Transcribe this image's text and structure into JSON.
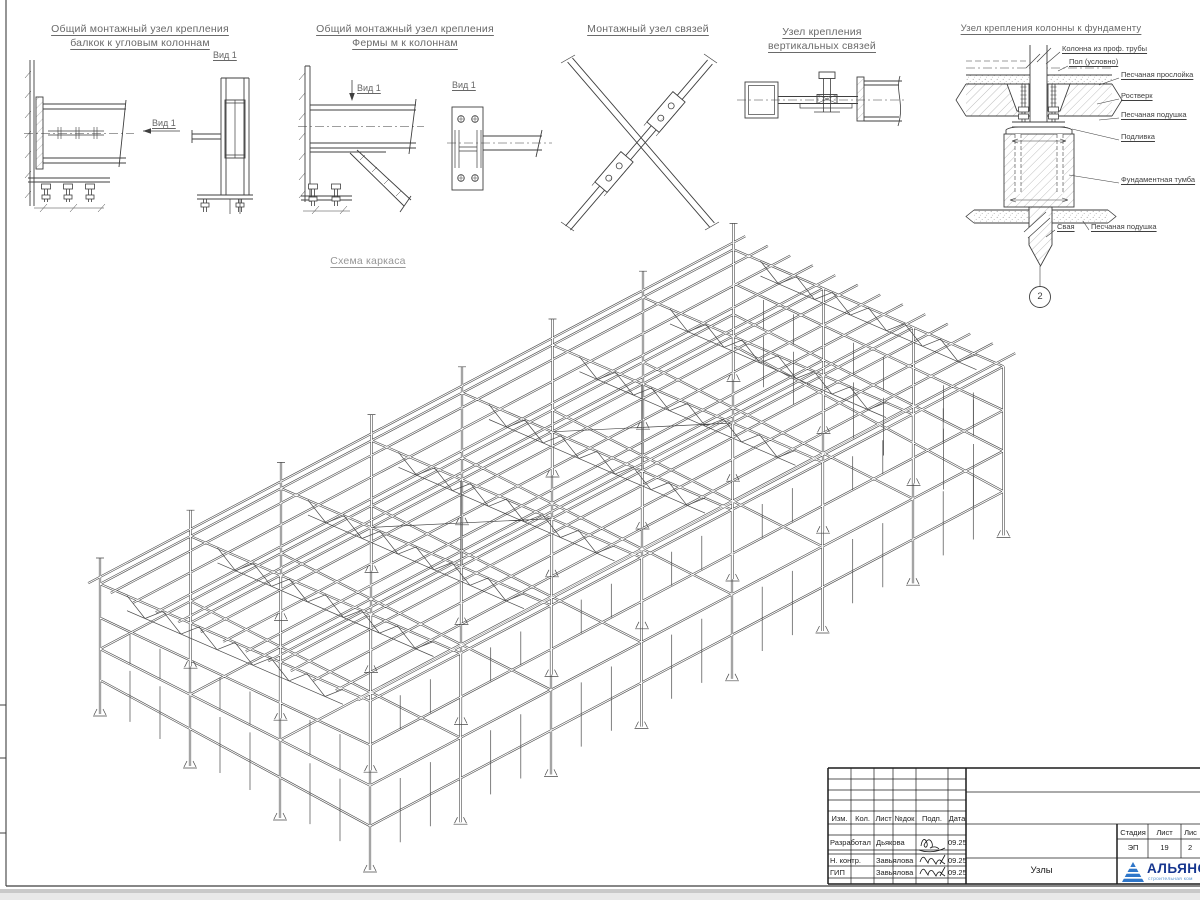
{
  "sheet": {
    "line_color": "#3f3f3f",
    "accent_blue": "#16368f"
  },
  "details": {
    "d1": {
      "title1": "Общий монтажный узел крепления",
      "title2": "балкок к угловым колоннам",
      "view": "Вид 1"
    },
    "d2": {
      "title1": "Общий монтажный узел крепления",
      "title2": "Фермы м к колоннам",
      "view": "Вид 1"
    },
    "d3": {
      "title": "Монтажный узел связей"
    },
    "d4": {
      "title1": "Узел крепления",
      "title2": "вертикальных связей"
    },
    "d5": {
      "title": "Узел крепления колонны к фундаменту",
      "lbl_column": "Колонна из проф. трубы",
      "lbl_floor": "Пол (условно)",
      "lbl_sand_layer": "Песчаная прослойка",
      "lbl_grillage": "Ростверк",
      "lbl_sand_pad": "Песчаная подушка",
      "lbl_grout": "Подливка",
      "lbl_pedestal": "Фундаментная тумба",
      "lbl_pile": "Свая",
      "lbl_sand_pad2": "Песчаная подушка",
      "marker": "2"
    }
  },
  "scheme": {
    "title": "Схема каркаса",
    "bays_length": 7,
    "bays_depth": 3,
    "stories": 2
  },
  "title_block": {
    "col_izm": "Изм.",
    "col_kol": "Кол.",
    "col_list": "Лист",
    "col_ndok": "№док",
    "col_podp": "Подп.",
    "col_data": "Дата",
    "row1_role": "Разработал",
    "row1_name": "Дьякова",
    "row1_date": "09.25",
    "row2_role": "Н. контр.",
    "row2_name": "Завьялова",
    "row2_date": "09.25",
    "row3_role": "ГИП",
    "row3_name": "Завьялова",
    "row3_date": "09.25",
    "doc_title": "Узлы",
    "stage_h": "Стадия",
    "sheet_h": "Лист",
    "sheets_h": "Лис",
    "stage_v": "ЭП",
    "sheet_v": "19",
    "sheets_v": "2",
    "logo_text": "АЛЬЯНС",
    "logo_sub": "строительная ком"
  }
}
